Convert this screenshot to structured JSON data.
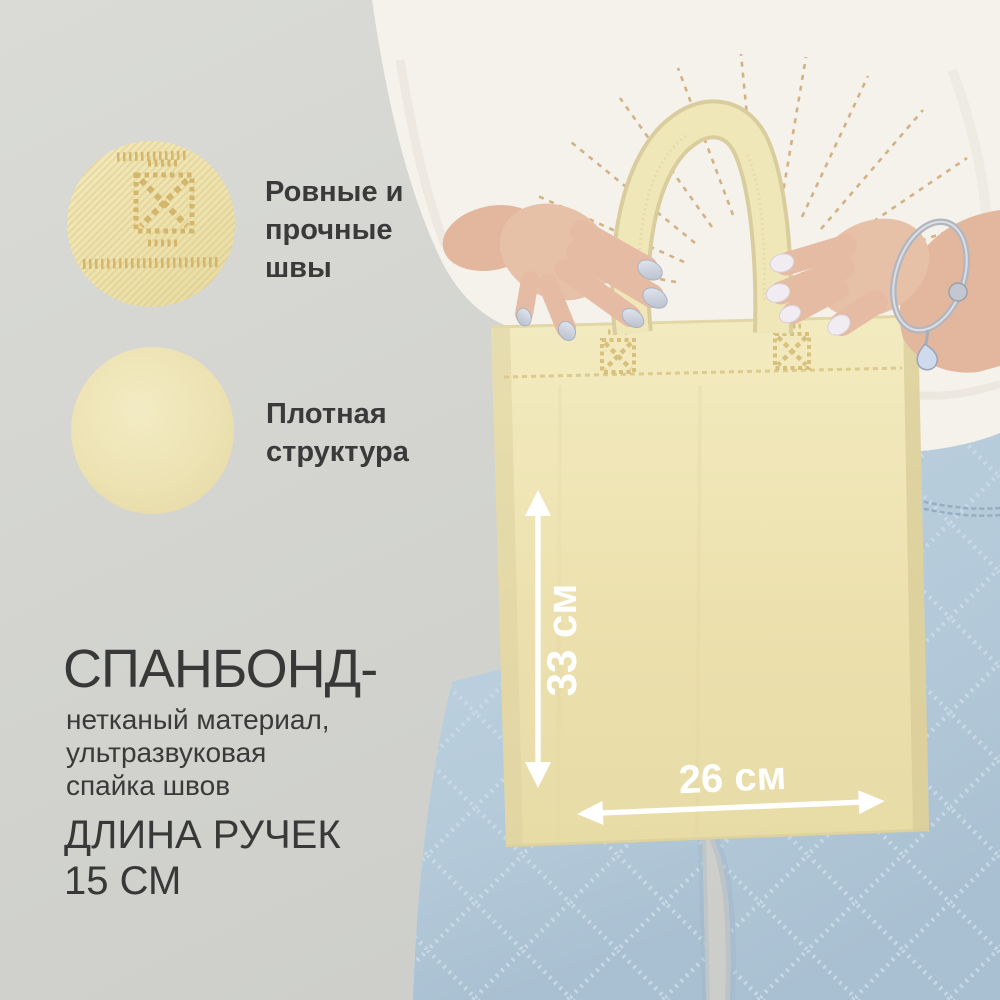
{
  "annotations": {
    "feature_seams": {
      "label": "Ровные и\nпрочные\nшвы"
    },
    "feature_texture": {
      "label": "Плотная\nструктура"
    },
    "material": {
      "title": "СПАНБОНД-",
      "description": "нетканый материал,\nультразвуковая\nспайка швов"
    },
    "handle_length": {
      "line1": "ДЛИНА РУЧЕК",
      "line2": "15 СМ"
    },
    "measurements": {
      "bag_height": "33 см",
      "bag_width": "26 см"
    }
  },
  "colors": {
    "background_gray": "#d3d4d0",
    "bag_cream": "#ece2af",
    "annotation_text": "#3a3a3a",
    "measurement_white": "#ffffff",
    "jeans_blue": "#b7cbdb",
    "shirt_white": "#f5f2ec",
    "embroidery_gold": "#c79d62",
    "nails_left": "#c9cfdb",
    "nails_right": "#f1ecf2"
  }
}
